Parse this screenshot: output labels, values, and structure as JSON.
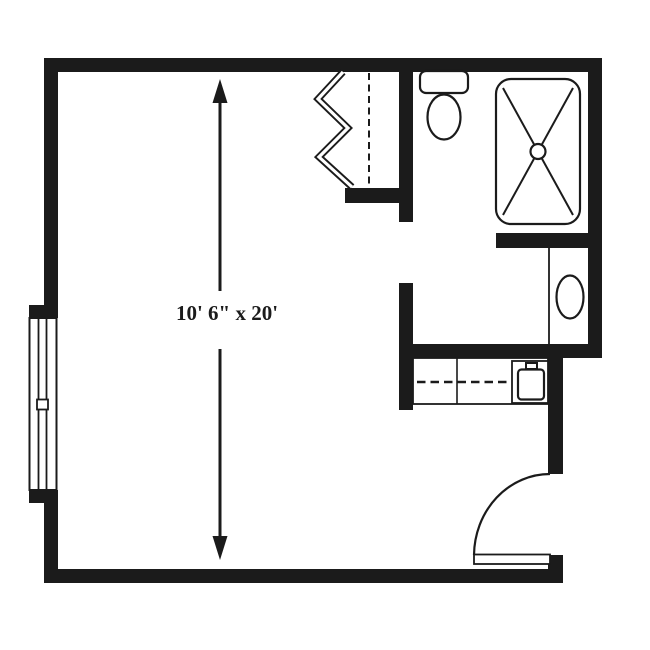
{
  "canvas": {
    "width": 650,
    "height": 650,
    "background_color": "#ffffff",
    "ink_color": "#1b1b1b"
  },
  "floorplan": {
    "dimension_label": "10' 6\" x 20'",
    "fixtures": [
      "window-icon",
      "accordion-closet-door-icon",
      "closet-rod-dashed-line",
      "toilet-icon",
      "shower-with-drain-icon",
      "vanity-sink-icon",
      "kitchenette-counter",
      "kitchenette-sink-icon",
      "entry-door-swing-icon",
      "dimension-arrow"
    ]
  }
}
